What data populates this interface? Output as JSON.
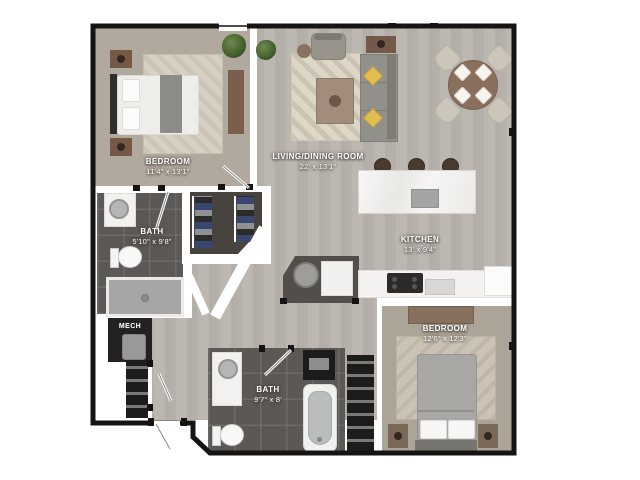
{
  "floorplan": {
    "rooms": [
      {
        "id": "bedroom-1",
        "label": "BEDROOM",
        "dims": "11'4\" x 13'1\""
      },
      {
        "id": "living-dining",
        "label": "LIVING/DINING ROOM",
        "dims": "22' x 13'1\""
      },
      {
        "id": "bath-1",
        "label": "BATH",
        "dims": "5'10\" x 9'8\""
      },
      {
        "id": "kitchen",
        "label": "KITCHEN",
        "dims": "13' x 9'4\""
      },
      {
        "id": "mech",
        "label": "MECH",
        "dims": ""
      },
      {
        "id": "bath-2",
        "label": "BATH",
        "dims": "9'7\" x 8'"
      },
      {
        "id": "bedroom-2",
        "label": "BEDROOM",
        "dims": "12'6\" x 12'3\""
      }
    ],
    "furniture": [
      "bed",
      "nightstand",
      "dresser",
      "plant",
      "armchair",
      "sofa",
      "coffee-table",
      "side-table",
      "console-table",
      "rug",
      "dining-table",
      "dining-chair",
      "kitchen-island",
      "bar-stool",
      "island-sink",
      "cooktop",
      "refrigerator",
      "dishwasher",
      "vanity-sink",
      "toilet",
      "shower",
      "bathtub",
      "washer",
      "water-heater",
      "closet-shelves",
      "wardrobe"
    ],
    "colors": {
      "wall": "#141414",
      "wood_floor": "#b6b1ab",
      "carpet": "#b1a99d",
      "dark_tile": "#5b5855",
      "closet_floor": "#474440",
      "accent_pillow": "#e4bd50",
      "island_counter": "#f4f3f1",
      "background": "#ffffff"
    }
  }
}
